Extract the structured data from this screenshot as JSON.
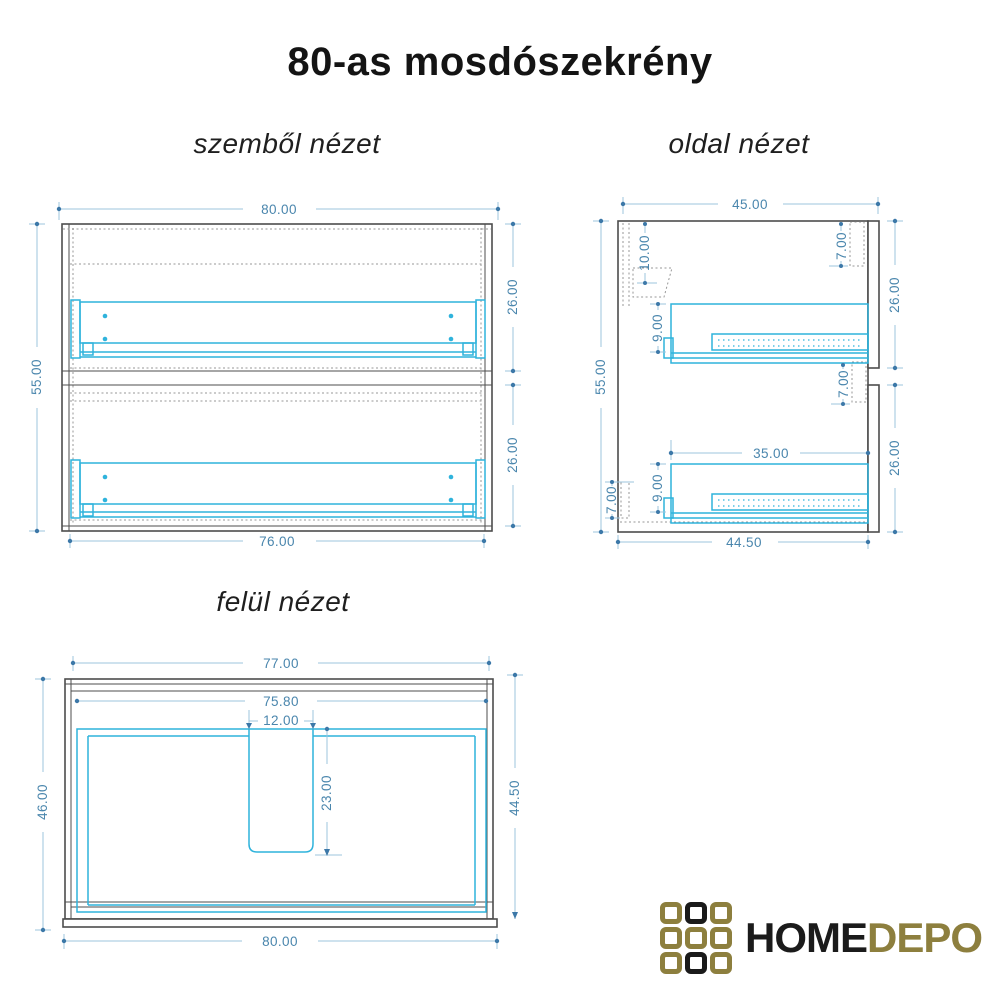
{
  "title": "80-as mosdószekrény",
  "views": {
    "front": {
      "label": "szemből nézet",
      "dims": {
        "overall_width": "80.00",
        "overall_height": "55.00",
        "upper_drawer_height": "26.00",
        "lower_drawer_height": "26.00",
        "inner_width": "76.00"
      }
    },
    "side": {
      "label": "oldal nézet",
      "dims": {
        "overall_depth": "45.00",
        "overall_height": "55.00",
        "bracket_offset": "10.00",
        "front_top_inset": "7.00",
        "upper_drawer_height": "26.00",
        "front_mid_inset": "7.00",
        "lower_drawer_height": "26.00",
        "upper_slide_offset": "9.00",
        "drawer_depth": "35.00",
        "lower_slide_offset": "9.00",
        "back_rail_height": "7.00",
        "inner_depth": "44.50"
      }
    },
    "top": {
      "label": "felül nézet",
      "dims": {
        "carcass_width": "77.00",
        "inner_width": "75.80",
        "cutout_width": "12.00",
        "cutout_depth": "23.00",
        "depth_left": "46.00",
        "depth_right": "44.50",
        "overall_width": "80.00"
      }
    }
  },
  "logo": {
    "word_primary": "HOME",
    "word_secondary": "DEPO",
    "gold": "#8d7f3e",
    "black": "#1a1a1a",
    "grid": [
      "gold",
      "black",
      "gold",
      "gold",
      "gold",
      "gold",
      "gold",
      "black",
      "gold"
    ]
  },
  "colors": {
    "outline": "#4d4d4d",
    "drawer_cyan": "#2fb3dc",
    "dimension_line": "#9cc4de",
    "dimension_text": "#4a86ad",
    "hidden_line": "#979797"
  }
}
